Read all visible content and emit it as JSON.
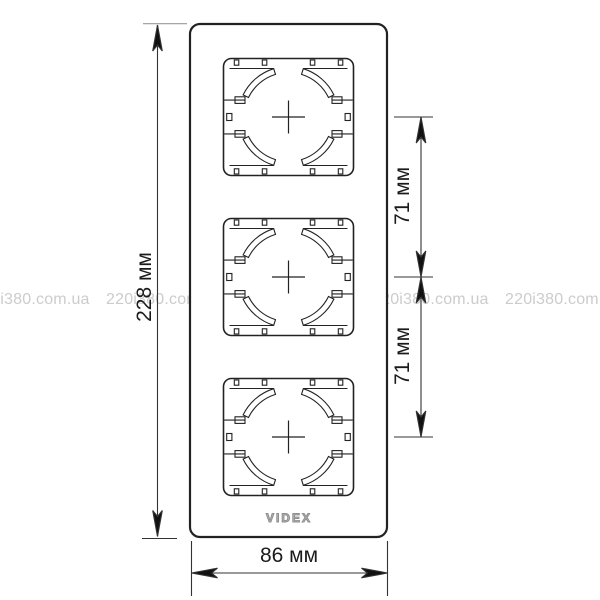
{
  "dimensions": {
    "height": "228 мм",
    "width": "86 мм",
    "spacing_upper": "71 мм",
    "spacing_lower": "71 мм"
  },
  "brand": {
    "logo": "VIDEX"
  },
  "watermark": {
    "text": "220i380.com.ua"
  },
  "colors": {
    "line": "#222222",
    "dimension_line": "#333333",
    "watermark": "#cccccc",
    "logo": "#8f8f8f",
    "background": "#ffffff"
  }
}
